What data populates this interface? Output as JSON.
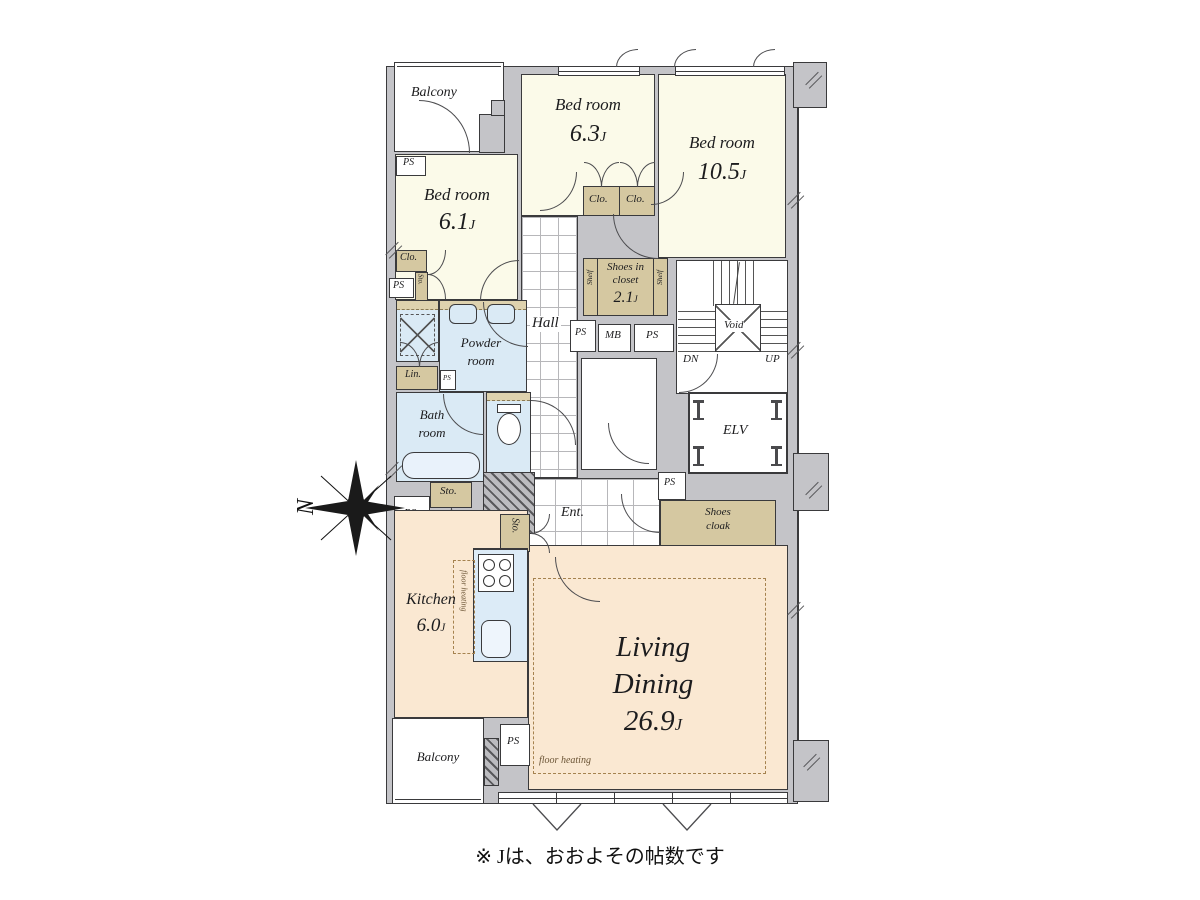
{
  "caption": "※ Jは、おおよその帖数です",
  "unit": "J",
  "labels": {
    "balcony": "Balcony",
    "bedroom": "Bed room",
    "bed1_size": "6.1",
    "bed2_size": "6.3",
    "bed3_size": "10.5",
    "clo": "Clo.",
    "ps": "PS",
    "sto": "Sto.",
    "mb": "MB",
    "lin": "Lin.",
    "shelf": "Shelf",
    "shoes_in_closet_l1": "Shoes in",
    "shoes_in_closet_l2": "closet",
    "shoes_in_closet_size": "2.1",
    "hall": "Hall",
    "ent": "Ent.",
    "powder_l1": "Powder",
    "powder_l2": "room",
    "bath_l1": "Bath",
    "bath_l2": "room",
    "void": "Void",
    "dn": "DN",
    "up": "UP",
    "elv": "ELV",
    "shoes_cloak_l1": "Shoes",
    "shoes_cloak_l2": "cloak",
    "kitchen": "Kitchen",
    "kitchen_size": "6.0",
    "living_l1": "Living",
    "living_l2": "Dining",
    "living_size": "26.9",
    "floor_heating": "floor heating",
    "north": "N"
  },
  "colors": {
    "wall": "#c4c4c8",
    "cream": "#fbfae9",
    "peach": "#fae8d2",
    "blue": "#daeaf5",
    "tan": "#d5c8a1",
    "dash": "#a5824f",
    "line": "#3a3a3c"
  }
}
